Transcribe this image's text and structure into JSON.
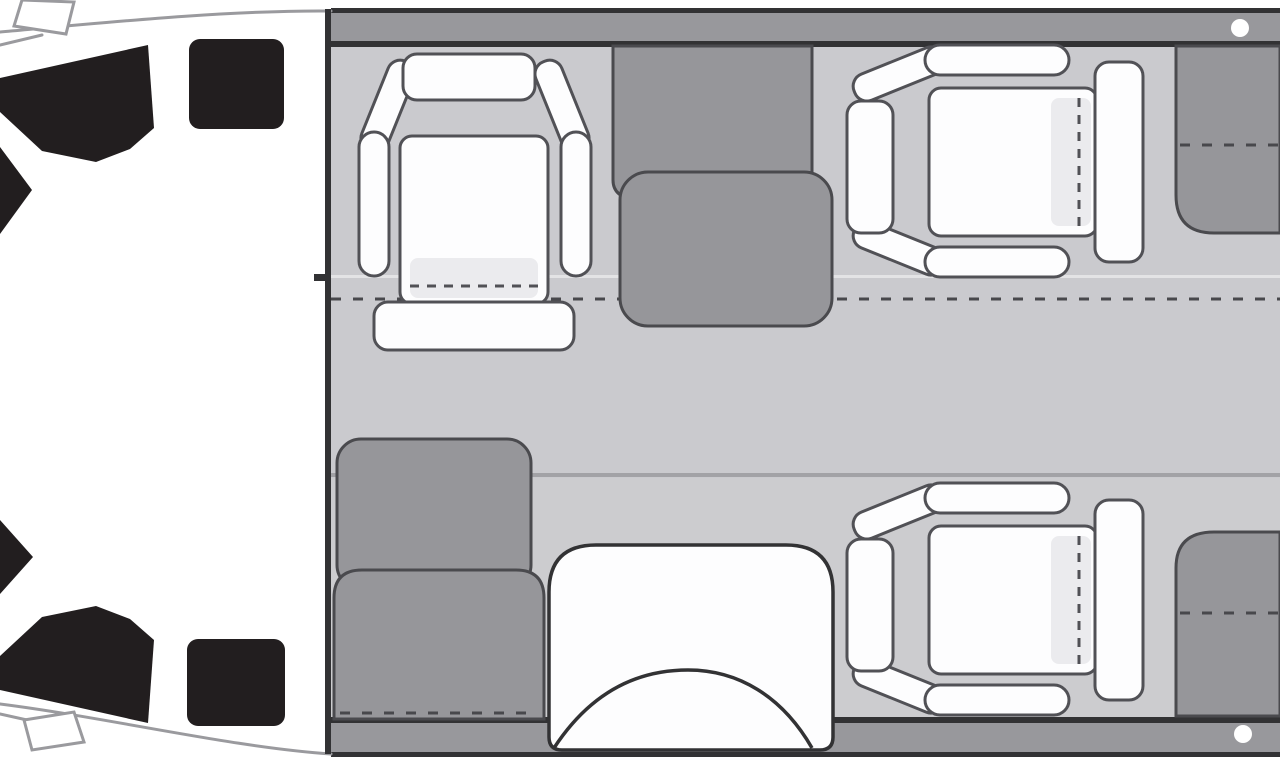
{
  "scene": {
    "description": "Top-down aircraft interior floor plan, nose at left, fuselage cropped at right edge",
    "cockpit": {
      "black_console_shapes": 2,
      "black_seat_squares": 2,
      "black_side_wedges": 2,
      "propeller_blade_marks": 2
    },
    "cabin": {
      "club_seats": 3,
      "seat_style": "white executive seats with headrest wings, armrests and footrest",
      "forward_cabinet_lobes": 2,
      "aft_left_cabinet_lobes": 2,
      "right_edge_cabinets": 2,
      "aft_bench_seats": 1,
      "window_markers": 2,
      "aisle_lines": 3
    }
  },
  "colors": {
    "background": "#ffffff",
    "hull-outline": "#9a9a9e",
    "wall-band": "#98989c",
    "wall-line-dark": "#323234",
    "cabin-floor": "#cacace",
    "cabin-floor-aft": "#cccccf",
    "aisle-line-light": "#e3e3e5",
    "dash-color": "#48484c",
    "mid-line": "#a2a2a6",
    "cabinet-fill": "#96969a",
    "cabinet-outline": "#4a4a4e",
    "seat-fill": "#fdfdfe",
    "seat-shade": "#ebebee",
    "seat-outline": "#515156",
    "cockpit-black": "#221e1f",
    "window-dot": "#ffffff"
  }
}
